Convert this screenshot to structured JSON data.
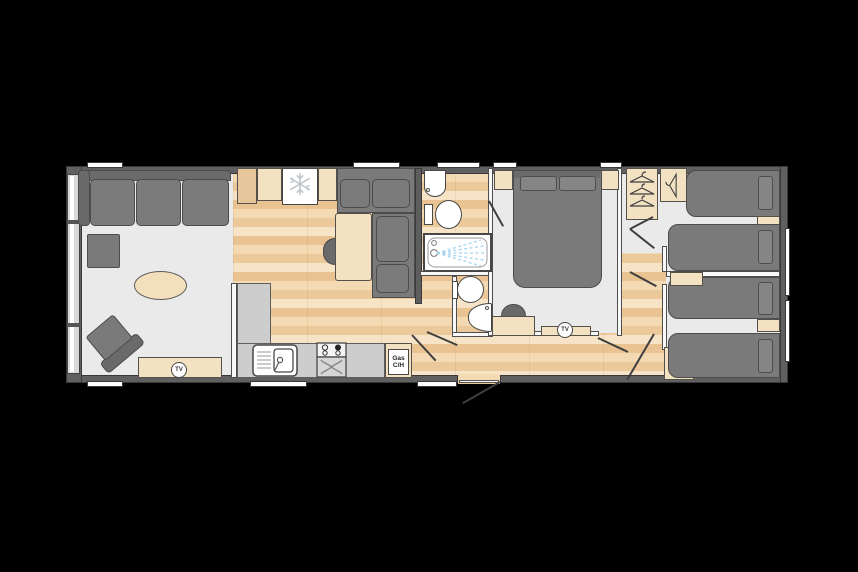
{
  "plan": {
    "kind": "holiday-home-floorplan",
    "labels": {
      "lounge_tv": "TV",
      "bedroom_tv": "TV",
      "gas_line1": "Gas",
      "gas_line2": "C/H"
    },
    "icons": {
      "fridge_freezer": "snowflake-icon",
      "wardrobes": "clothes-hanger-icon",
      "oven": "fan-icon",
      "bath": "shower-spray-icon",
      "tv_points": "tv-circle-badge"
    },
    "colors": {
      "background": "#000000",
      "exterior_wall": "#606060",
      "interior_wall": "#f8f8f8",
      "hard_floor": "#eaeaea",
      "wood_floor": "#eccda2",
      "furniture_gray": "#7a7a7a",
      "furniture_cream": "#f2e2c2",
      "fixture_white": "#ffffff",
      "worktop_gray": "#cdcdcd",
      "shower_spray_blue": "#a6d4ef"
    }
  }
}
